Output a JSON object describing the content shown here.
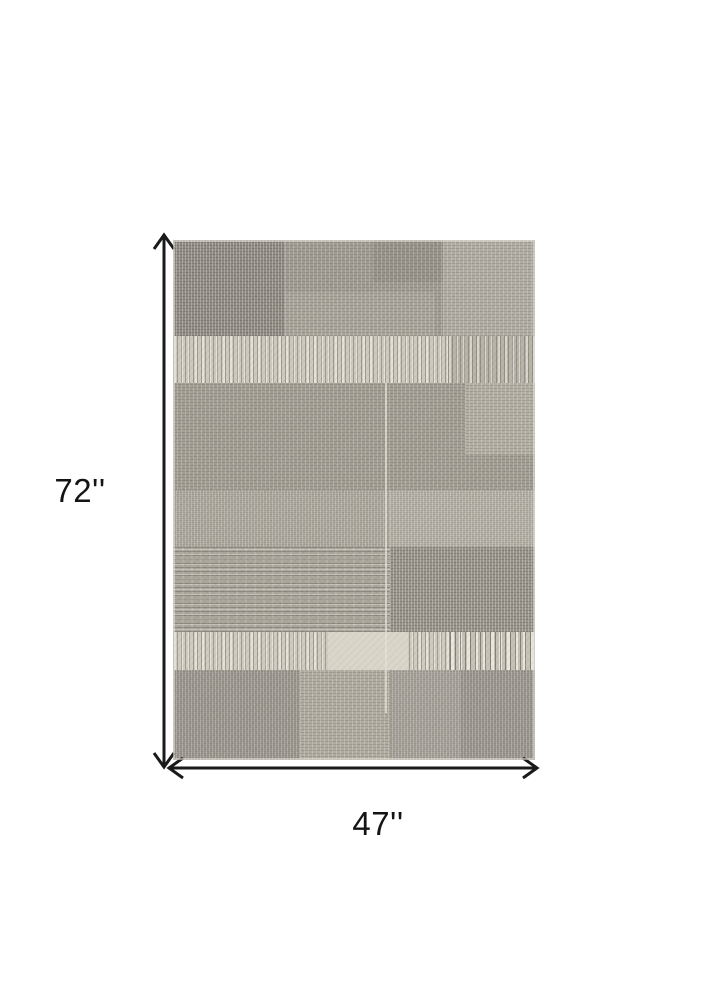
{
  "figure": {
    "type": "product-dimension-diagram",
    "subject": "abstract patchwork area rug, gray and taupe",
    "background_color": "#ffffff"
  },
  "dimensions": {
    "height_label": "72''",
    "width_label": "47''",
    "arrow_color": "#1a1a1a",
    "label_color": "#141414"
  },
  "rug_palette": {
    "base": "#a8a49a",
    "dark_block": "#8f8b83",
    "medium_gray": "#a09c93",
    "light_band": "#cdc9bc",
    "cream_highlight": "#d9d5c8",
    "bottom_gray": "#9a968d",
    "edge_fringe": "#e0ddd4"
  },
  "icons": {
    "vertical_arrow": "double-headed-vertical-arrow",
    "horizontal_arrow": "double-headed-horizontal-arrow"
  }
}
